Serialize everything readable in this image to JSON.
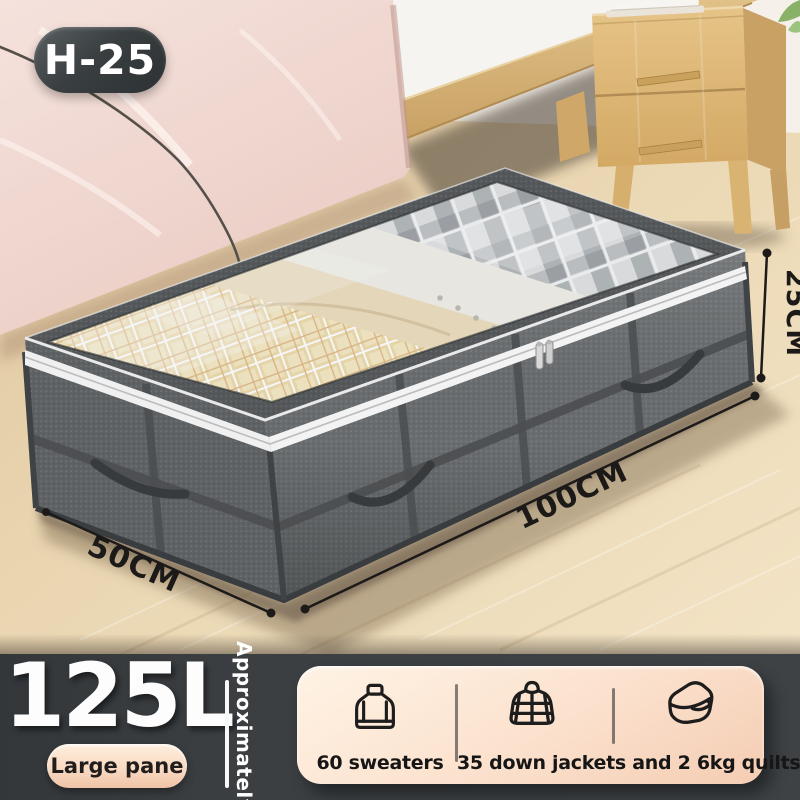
{
  "badge": {
    "label": "H-25"
  },
  "annotations": {
    "height": "25CM",
    "length": "100CM",
    "width": "50CM"
  },
  "banner": {
    "capacity": "125L",
    "capacity_tag": "Large pane",
    "side_label": "Approximately",
    "icons": [
      "sweater-icon",
      "down-jacket-icon",
      "quilt-icon"
    ],
    "captions": [
      "60 sweaters",
      "35 down jackets and 2 6kg quilts"
    ]
  },
  "colors": {
    "banner_bg": "#3b3f42",
    "panel_cream_top": "#fff3e5",
    "panel_cream_bottom": "#f4ccb2",
    "badge_bg": "#3a3f41",
    "text_light": "#ffffff",
    "text_dark": "#161616",
    "annotation_ink": "#1c1a18",
    "box_fabric": "#696d6f",
    "box_fabric_side": "#5e6264",
    "floor_wood": "#e9d5b0",
    "bedding_pink": "#f2dcd4",
    "nightstand_wood": "#ddb97c"
  }
}
